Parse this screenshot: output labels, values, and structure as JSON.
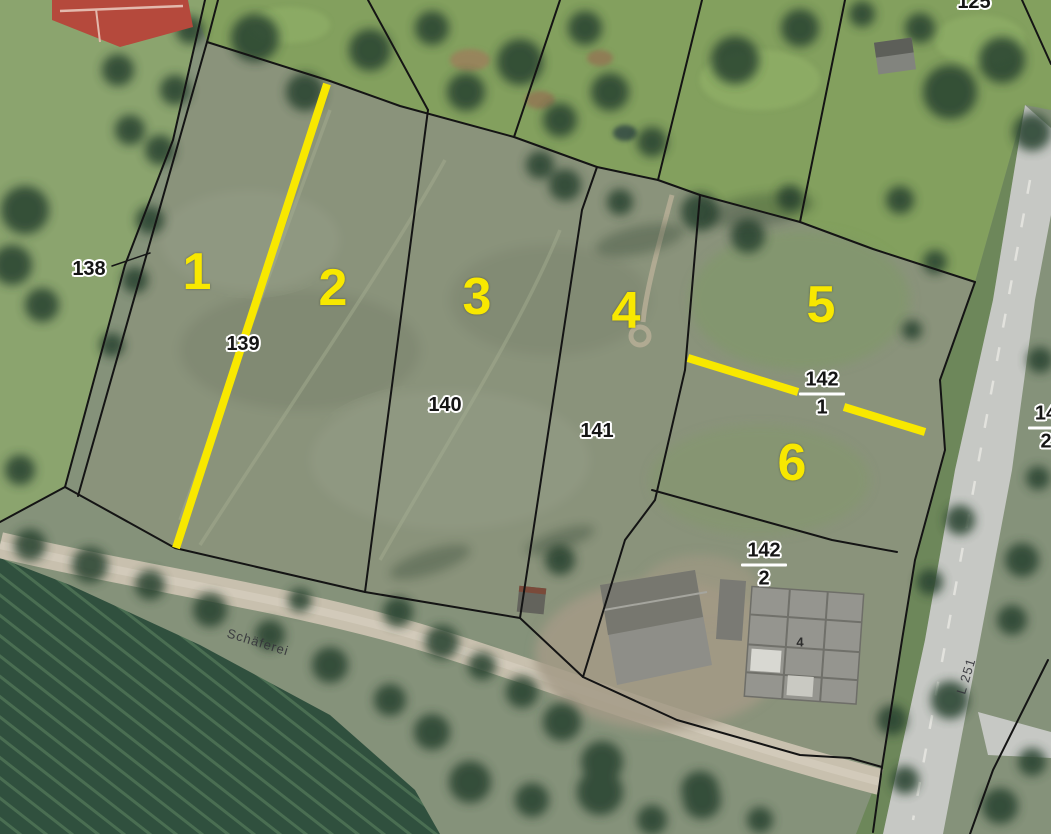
{
  "map": {
    "colors": {
      "highlight_yellow": "#f8e800",
      "boundary_black": "#141414",
      "label_halo": "#ffffff",
      "meadow_green": "#8a937b",
      "field_dark_green": "#30503e",
      "road_gray": "#c6c8c4",
      "roof_red": "#b5493c"
    },
    "labels": {
      "yellow_plots": [
        {
          "text": "1"
        },
        {
          "text": "2"
        },
        {
          "text": "3"
        },
        {
          "text": "4"
        },
        {
          "text": "5"
        },
        {
          "text": "6"
        }
      ],
      "parcels": [
        {
          "text": "138"
        },
        {
          "text": "139"
        },
        {
          "text": "140"
        },
        {
          "text": "141"
        }
      ],
      "fractions": [
        {
          "numerator": "142",
          "denominator": "1"
        },
        {
          "numerator": "142",
          "denominator": "2"
        },
        {
          "numerator": "14",
          "denominator": "2",
          "clipped_at_edge": true
        }
      ],
      "edge_top": {
        "text": "125",
        "clipped_at_edge": true
      },
      "house_number": {
        "text": "4"
      },
      "streets": {
        "lane": {
          "text": "Schäferei"
        },
        "road": {
          "text": "L 251"
        }
      }
    }
  }
}
